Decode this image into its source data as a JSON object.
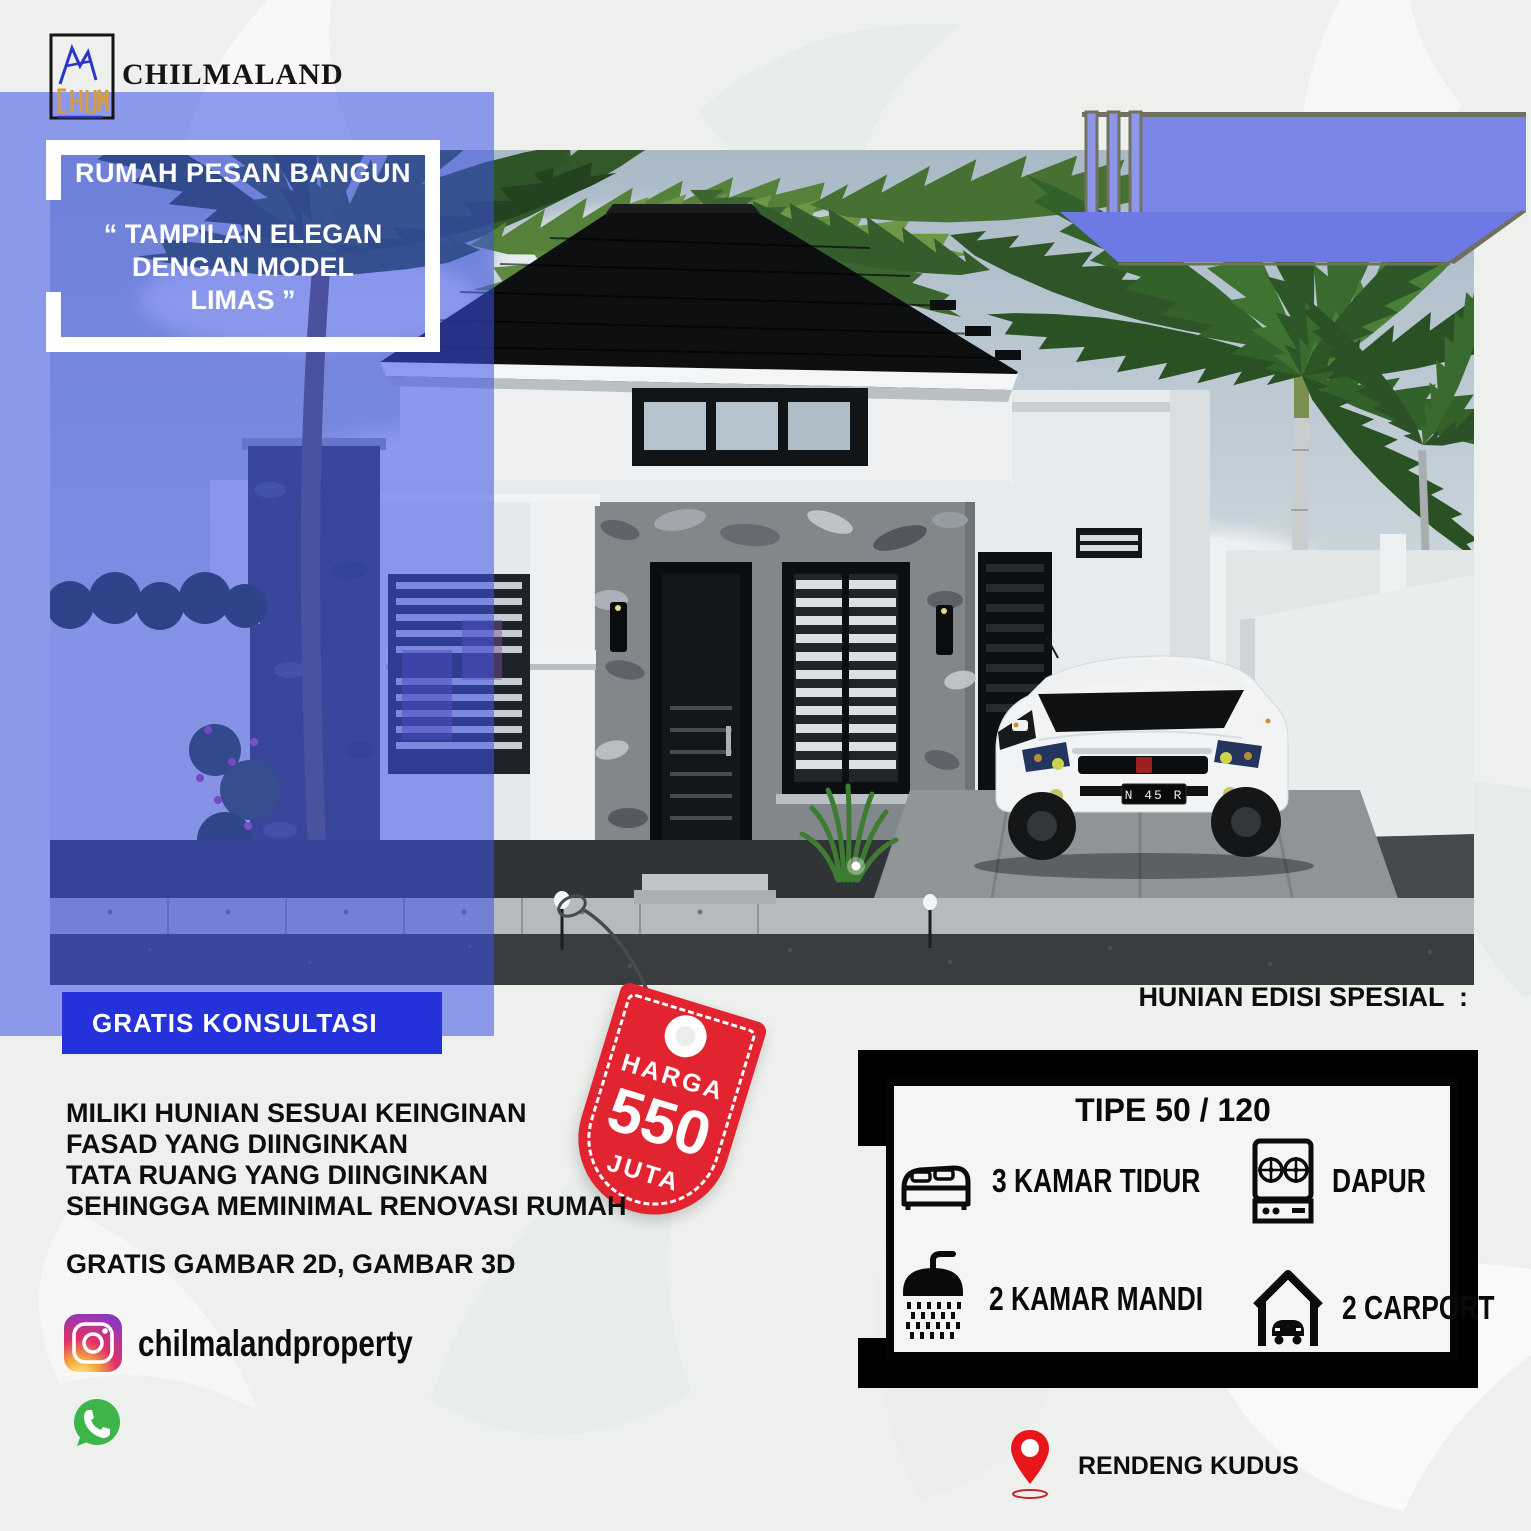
{
  "brand": {
    "name": "CHILMALAND"
  },
  "banner": {
    "headline": "RUMAH PESAN BANGUN",
    "quote_lines": [
      "“ TAMPILAN ELEGAN",
      "DENGAN MODEL",
      "LIMAS ”"
    ]
  },
  "consultation": {
    "label": "GRATIS KONSULTASI"
  },
  "price_tag": {
    "label": "HARGA",
    "amount": "550",
    "unit": "JUTA"
  },
  "pitch": {
    "lines": [
      "MILIKI HUNIAN SESUAI KEINGINAN",
      "FASAD YANG DIINGINKAN",
      "TATA RUANG YANG DIINGINKAN",
      "SEHINGGA MEMINIMAL RENOVASI RUMAH"
    ],
    "free_offer": "GRATIS GAMBAR 2D, GAMBAR 3D"
  },
  "social": {
    "instagram": "chilmalandproperty"
  },
  "special": {
    "heading": "HUNIAN EDISI SPESIAL  :"
  },
  "spec_box": {
    "title": "TIPE 50 / 120",
    "items": [
      {
        "icon": "bed-icon",
        "label": "3 KAMAR TIDUR"
      },
      {
        "icon": "stove-icon",
        "label": "DAPUR"
      },
      {
        "icon": "shower-icon",
        "label": "2 KAMAR MANDI"
      },
      {
        "icon": "carport-icon",
        "label": "2 CARPORT"
      }
    ]
  },
  "location": {
    "label": "RENDENG KUDUS"
  },
  "photo": {
    "car_plate": "N 45 R"
  },
  "colors": {
    "background": "#eef0ed",
    "overlay_blue": "#3d50e8",
    "button_blue": "#2531da",
    "banner_blue": "#7b85e7",
    "tag_red": "#e1242f",
    "pin_red": "#e8151b"
  }
}
